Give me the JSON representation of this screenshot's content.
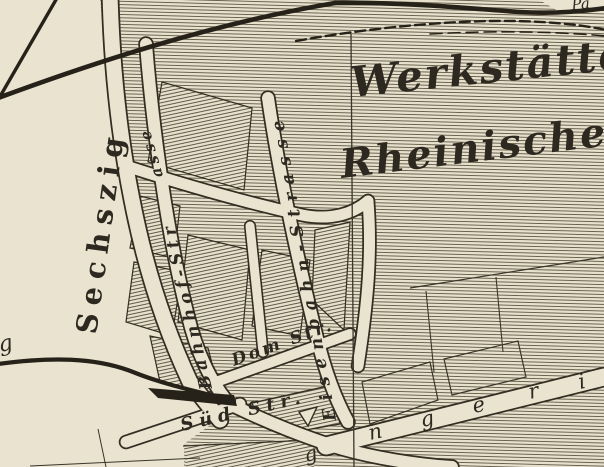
{
  "map_type": "historic-engraved-city-map",
  "colors": {
    "paper": "#eae3d0",
    "ink": "#2d2920",
    "hatch_line": "#57503d"
  },
  "labels": {
    "region_line1": "Werkstätte",
    "region_line2": "Rheinischen",
    "street_sechszig": "Sechszig",
    "street_bahnhof": "Bahnhof-Str",
    "street_bahnhof_cont": "asse",
    "street_eisenbahn": "Eisenbahn-Strasse",
    "street_dom": "Dom Str.",
    "street_sued": "Süd Str.",
    "corner_top_right_fragment": "Pa",
    "left_edge_fragment": "g",
    "bottom_fragment": "g",
    "scattered_street_letters": [
      "n",
      "g",
      "e",
      "r",
      "i"
    ]
  }
}
